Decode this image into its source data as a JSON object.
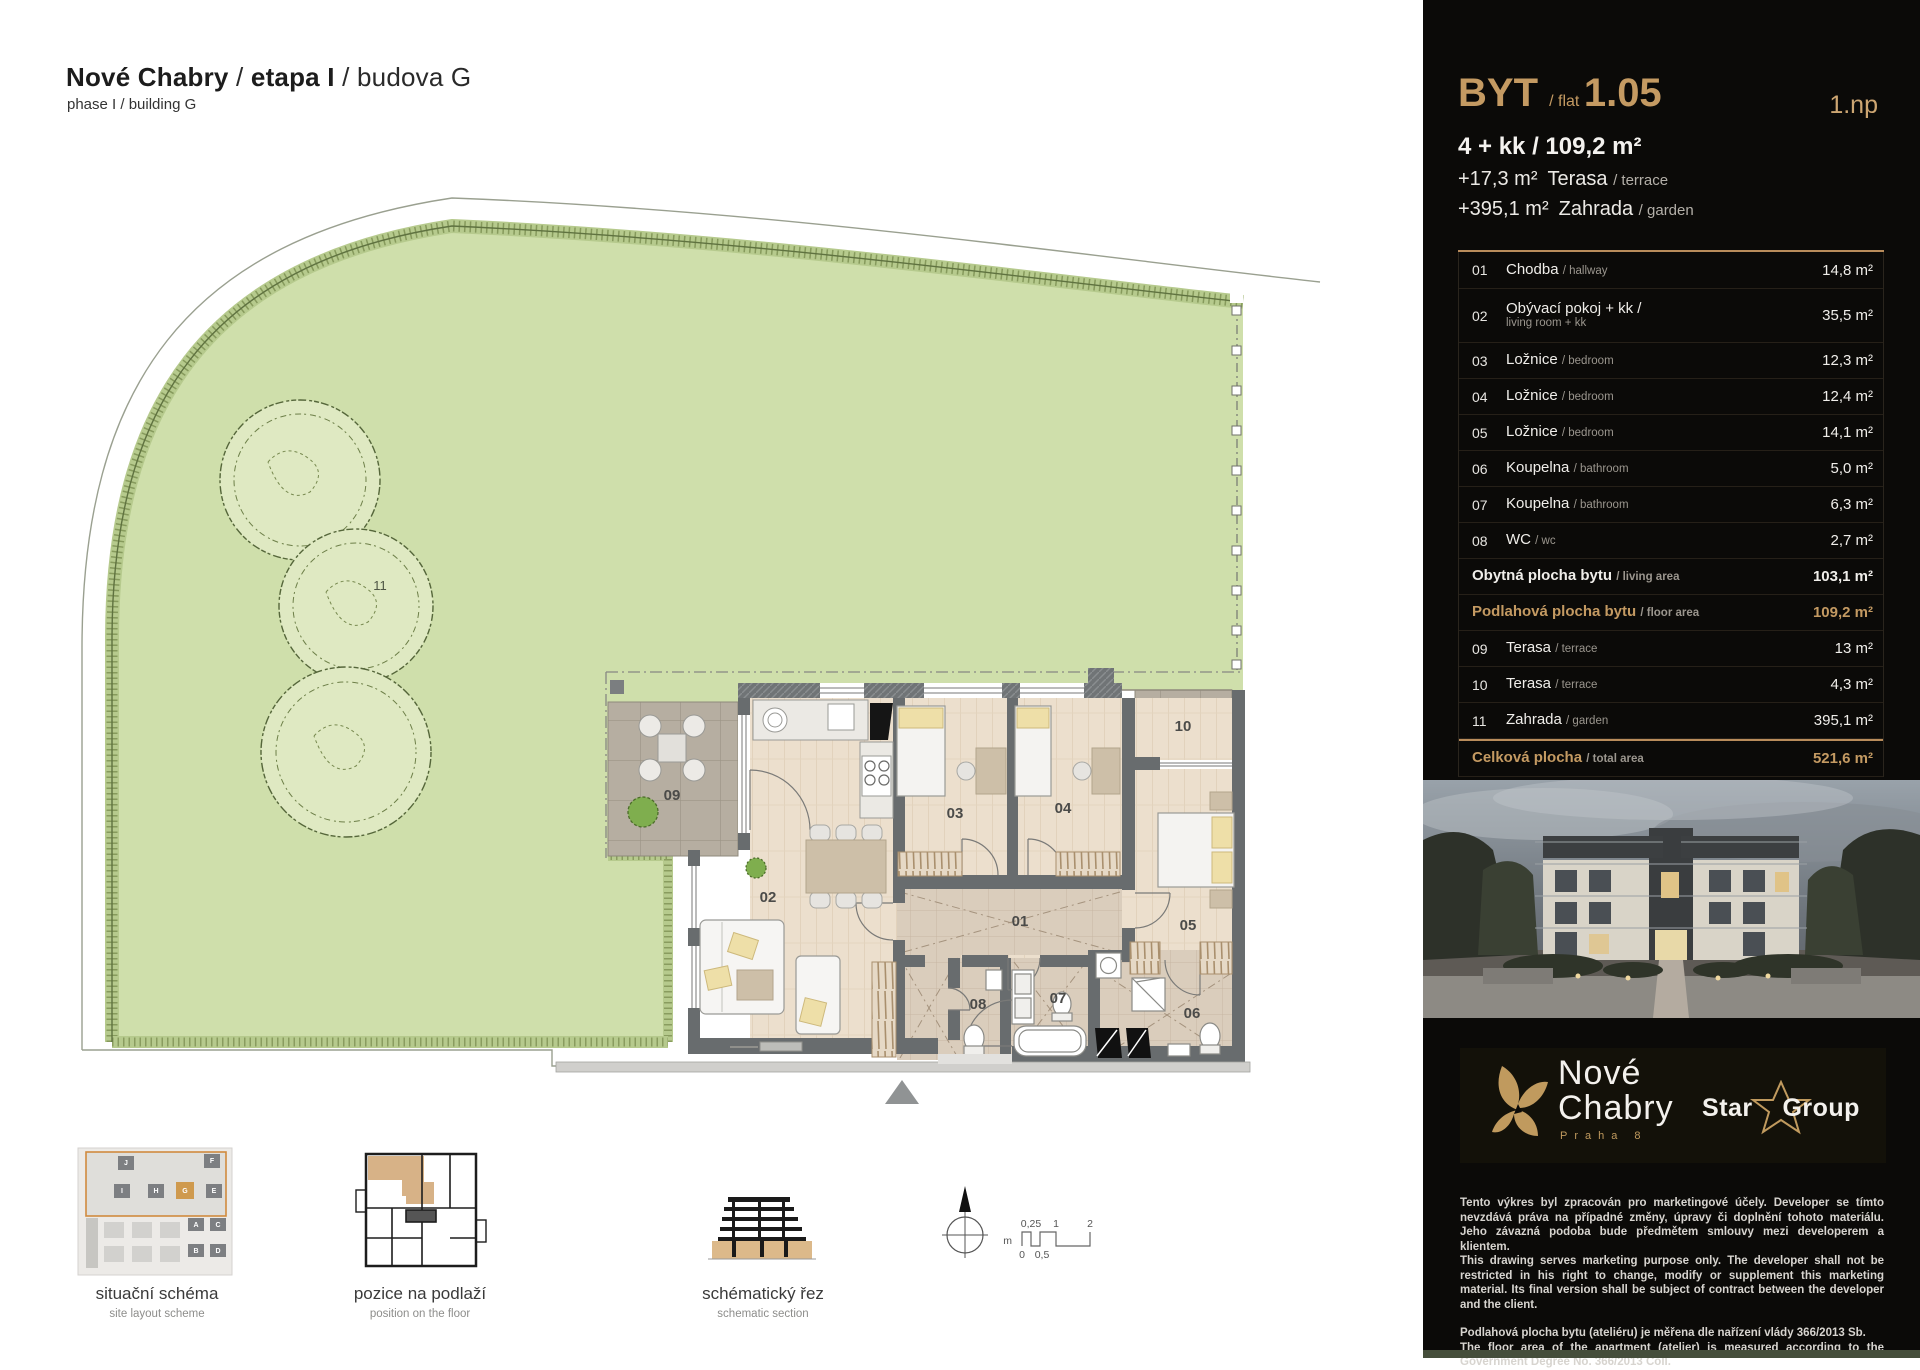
{
  "header": {
    "title_project": "Nové Chabry",
    "sep": "/",
    "title_phase": "etapa I",
    "title_building": "budova G",
    "subtitle": "phase I / building G"
  },
  "plan": {
    "labels": {
      "r01": "01",
      "r02": "02",
      "r03": "03",
      "r04": "04",
      "r05": "05",
      "r06": "06",
      "r07": "07",
      "r08": "08",
      "r09": "09",
      "r10": "10",
      "garden": "11"
    }
  },
  "thumbnails": {
    "site": {
      "label": "situační schéma",
      "sublabel": "site layout scheme",
      "buildings": [
        "J",
        "F",
        "I",
        "H",
        "G",
        "E",
        "A",
        "C",
        "B",
        "D"
      ]
    },
    "floor": {
      "label": "pozice na podlaží",
      "sublabel": "position on the floor"
    },
    "section": {
      "label": "schématický řez",
      "sublabel": "schematic section"
    }
  },
  "scalebar": {
    "unit": "m",
    "t1": "0,25",
    "t2": "1",
    "t3": "2",
    "b1": "0",
    "b2": "0,5"
  },
  "panel": {
    "flat": {
      "label_cz": "BYT",
      "sep": "/",
      "label_en": "flat",
      "number": "1.05",
      "floor": "1.np",
      "layout": "4 + kk / 109,2 m²",
      "terrace_line": {
        "value": "+17,3 m²",
        "name": "Terasa",
        "sub": "/ terrace"
      },
      "garden_line": {
        "value": "+395,1 m²",
        "name": "Zahrada",
        "sub": "/ garden"
      }
    },
    "table": {
      "rows": [
        {
          "num": "01",
          "name": "Chodba ",
          "sub": "/ hallway",
          "value": "14,8 m²"
        },
        {
          "num": "02",
          "name": "Obývací pokoj + kk /",
          "sub": "living room + kk",
          "value": "35,5 m²"
        },
        {
          "num": "03",
          "name": "Ložnice ",
          "sub": "/ bedroom",
          "value": "12,3 m²"
        },
        {
          "num": "04",
          "name": "Ložnice ",
          "sub": "/ bedroom",
          "value": "12,4 m²"
        },
        {
          "num": "05",
          "name": "Ložnice ",
          "sub": "/ bedroom",
          "value": "14,1 m²"
        },
        {
          "num": "06",
          "name": "Koupelna ",
          "sub": "/ bathroom",
          "value": "5,0 m²"
        },
        {
          "num": "07",
          "name": "Koupelna ",
          "sub": "/ bathroom",
          "value": "6,3 m²"
        },
        {
          "num": "08",
          "name": "WC ",
          "sub": "/ wc",
          "value": "2,7 m²"
        },
        {
          "num": "",
          "name": "Obytná plocha bytu ",
          "sub": "/ living area",
          "value": "103,1 m²"
        },
        {
          "num": "",
          "name": "Podlahová plocha bytu ",
          "sub": "/ floor area",
          "value": "109,2 m²"
        },
        {
          "num": "09",
          "name": "Terasa ",
          "sub": "/ terrace",
          "value": "13 m²"
        },
        {
          "num": "10",
          "name": "Terasa ",
          "sub": "/ terrace",
          "value": "4,3 m²"
        },
        {
          "num": "11",
          "name": "Zahrada ",
          "sub": "/ garden",
          "value": "395,1 m²"
        },
        {
          "num": "",
          "name": "Celková plocha ",
          "sub": "/ total area",
          "value": "521,6 m²"
        }
      ]
    },
    "logo": {
      "name_line1": "Nové",
      "name_line2": "Chabry",
      "city": "Praha 8",
      "partner_a": "Star",
      "partner_b": "Group"
    },
    "legal": {
      "p1": "Tento výkres byl zpracován pro marketingové účely. Developer se tímto nevzdává práva na případné změny, úpravy či doplnění tohoto materiálu. Jeho závazná podoba bude předmětem smlouvy mezi developerem a klientem.",
      "p2": "This drawing serves marketing purpose only. The developer shall not be restricted in his right to change, modify or supplement this marketing material. Its final version shall be subject of contract between the developer and the client.",
      "p3": "Podlahová plocha bytu (ateliéru) je měřena dle nařízení vlády 366/2013 Sb.",
      "p4": "The floor area of the apartment (atelier) is measured according to the Government Degree No. 366/2013 Coll."
    }
  },
  "colors": {
    "accent_gold": "#c49a62",
    "garden_green": "#cfdfab",
    "wall_grey": "#686c6e",
    "highlight_orange": "#d08a3e",
    "bottom_strip_olive": "#454e3b"
  }
}
